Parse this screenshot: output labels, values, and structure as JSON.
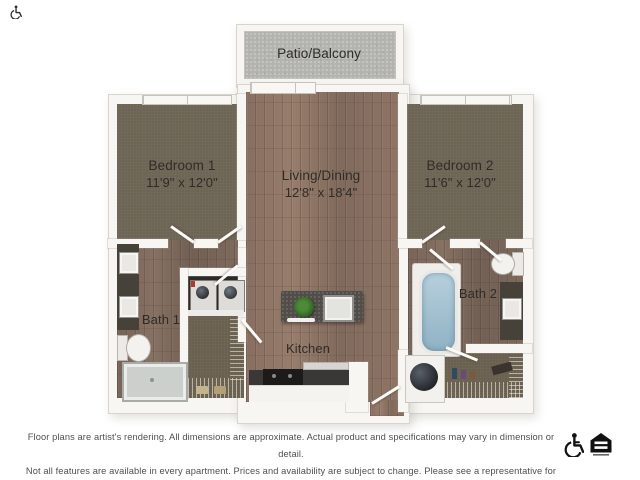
{
  "plan": {
    "patio": {
      "label": "Patio/Balcony"
    },
    "bedroom1": {
      "label": "Bedroom 1",
      "dims": "11'9\" x 12'0\""
    },
    "living": {
      "label": "Living/Dining",
      "dims": "12'8\" x 18'4\""
    },
    "bedroom2": {
      "label": "Bedroom 2",
      "dims": "11'6\" x 12'0\""
    },
    "bath1": {
      "label": "Bath 1"
    },
    "bath2": {
      "label": "Bath 2"
    },
    "kitchen": {
      "label": "Kitchen"
    }
  },
  "fixtures": [
    "double-vanity-sinks",
    "toilet",
    "walk-in-shower",
    "bathtub",
    "washer-dryer",
    "water-heater",
    "kitchen-island-with-sink",
    "range-stove",
    "wire-closet-shelving",
    "house-plant",
    "sliding-patio-door",
    "bedroom-windows"
  ],
  "footer": {
    "disclaimer_line1": "Floor plans are artist's rendering. All dimensions are approximate. Actual product and specifications may vary in dimension or detail.",
    "disclaimer_line2": "Not all features are available in every apartment. Prices and availability are subject to change. Please see a representative for details.",
    "icons": [
      "wheelchair-accessible-icon",
      "equal-housing-opportunity-icon"
    ]
  },
  "colors": {
    "wood_floor": "#8c7365",
    "carpet": "#6d6454",
    "patio_concrete": "#b3b3af",
    "wall": "#f7f6f3",
    "counter": "#3a3836",
    "tub_blue": "#a9c6d6",
    "label_text": "#2f2c28",
    "disclaimer_text": "#4f4f4f"
  }
}
